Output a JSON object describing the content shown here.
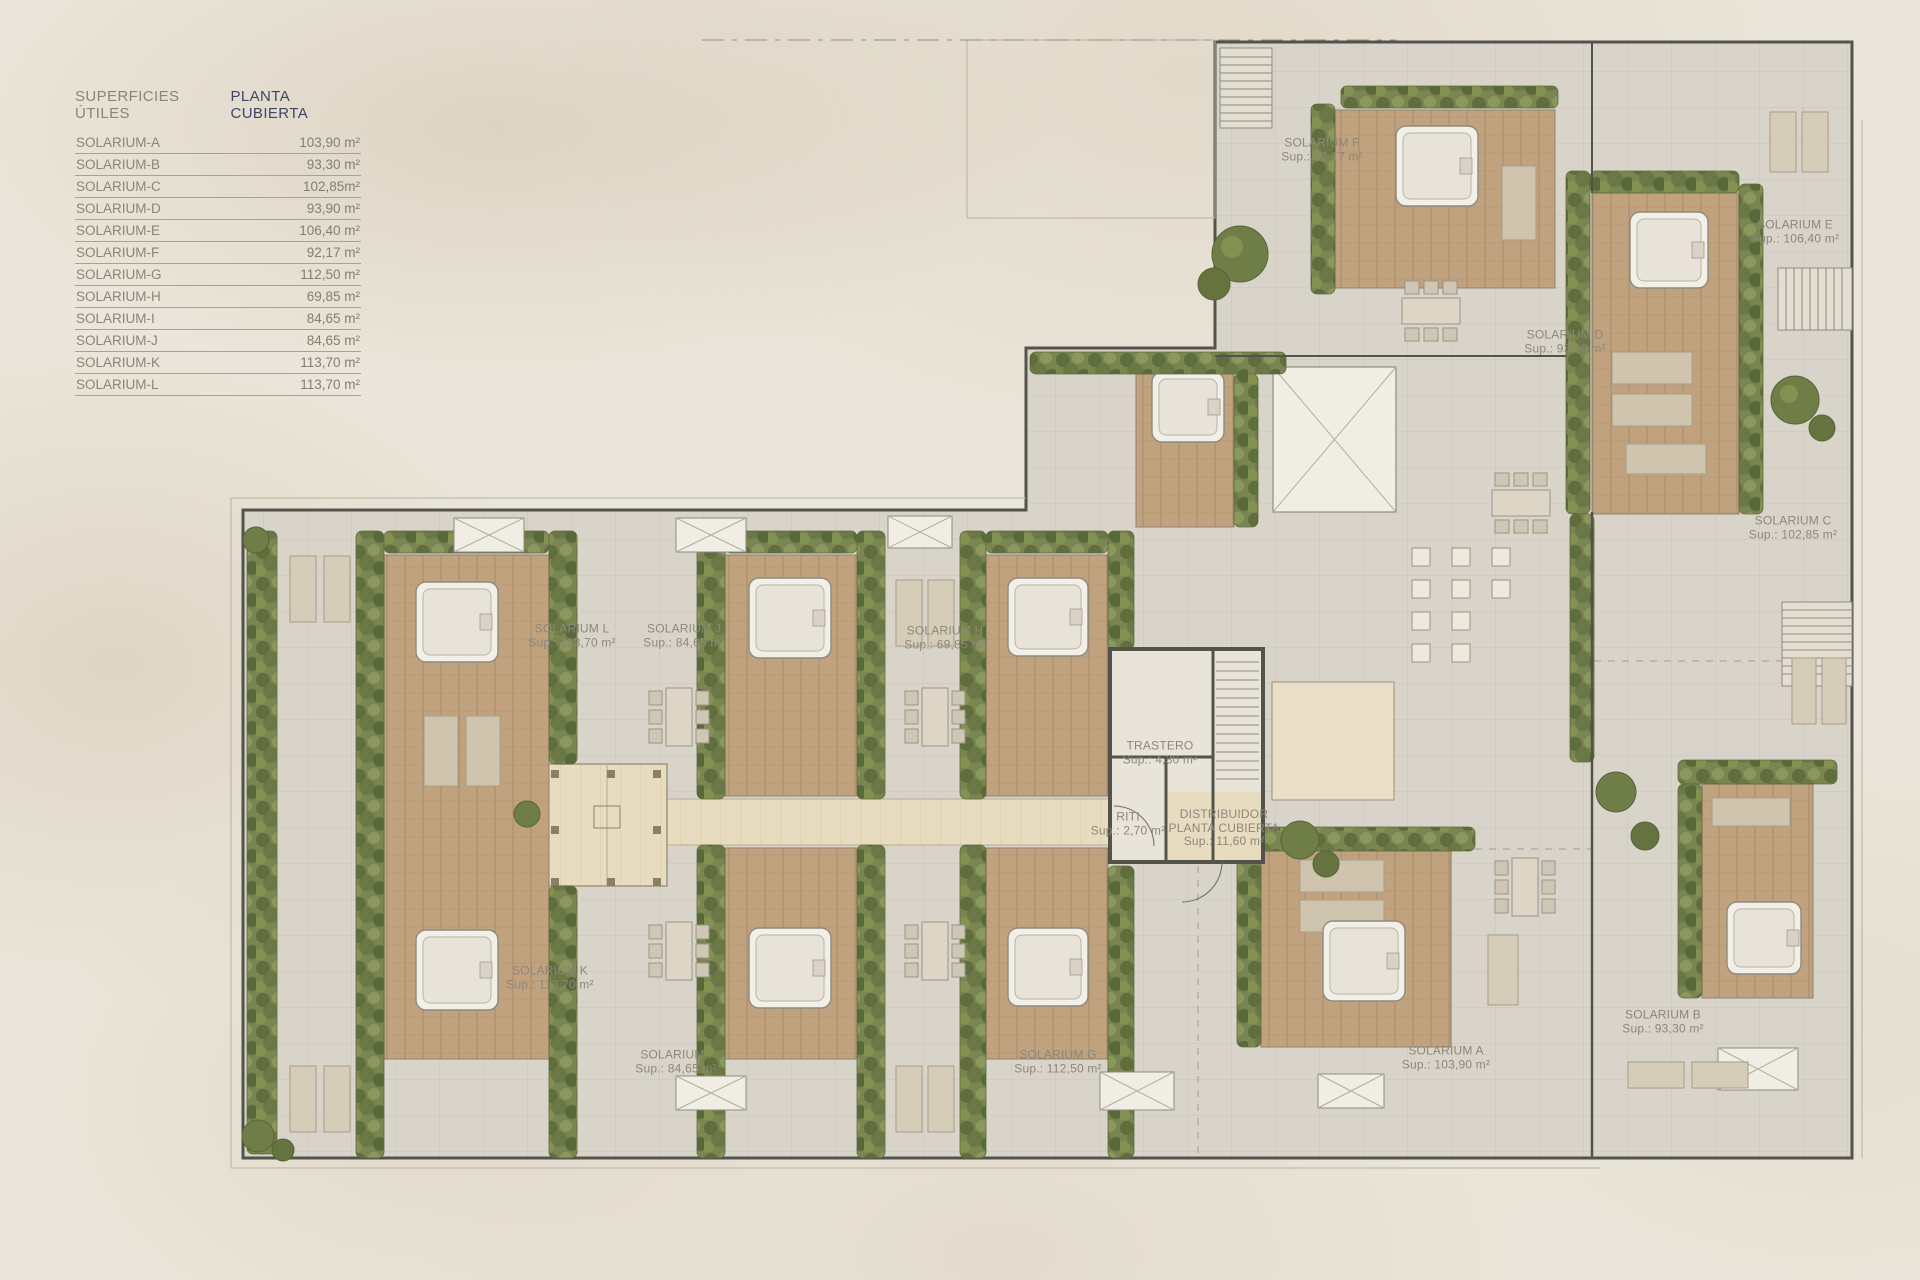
{
  "legend": {
    "title_left": "SUPERFICIES ÚTILES",
    "title_right": "PLANTA CUBIERTA",
    "rows": [
      {
        "label": "SOLARIUM-A",
        "value": "103,90 m²"
      },
      {
        "label": "SOLARIUM-B",
        "value": "93,30 m²"
      },
      {
        "label": "SOLARIUM-C",
        "value": "102,85m²"
      },
      {
        "label": "SOLARIUM-D",
        "value": "93,90 m²"
      },
      {
        "label": "SOLARIUM-E",
        "value": "106,40 m²"
      },
      {
        "label": "SOLARIUM-F",
        "value": "92,17 m²"
      },
      {
        "label": "SOLARIUM-G",
        "value": "112,50 m²"
      },
      {
        "label": "SOLARIUM-H",
        "value": "69,85 m²"
      },
      {
        "label": "SOLARIUM-I",
        "value": "84,65 m²"
      },
      {
        "label": "SOLARIUM-J",
        "value": "84,65 m²"
      },
      {
        "label": "SOLARIUM-K",
        "value": "113,70 m²"
      },
      {
        "label": "SOLARIUM-L",
        "value": "113,70 m²"
      }
    ]
  },
  "plan": {
    "labels": [
      {
        "id": "solarium-f",
        "lines": [
          "SOLARIUM F",
          "Sup.: 92,17 m²"
        ],
        "x": 1322,
        "y": 150
      },
      {
        "id": "solarium-e",
        "lines": [
          "SOLARIUM E",
          "Sup.: 106,40 m²"
        ],
        "x": 1795,
        "y": 232
      },
      {
        "id": "solarium-d",
        "lines": [
          "SOLARIUM D",
          "Sup.: 93,90 m²"
        ],
        "x": 1565,
        "y": 342
      },
      {
        "id": "solarium-c",
        "lines": [
          "SOLARIUM C",
          "Sup.: 102,85 m²"
        ],
        "x": 1793,
        "y": 528
      },
      {
        "id": "solarium-l",
        "lines": [
          "SOLARIUM L",
          "Sup.: 113,70 m²"
        ],
        "x": 572,
        "y": 636
      },
      {
        "id": "solarium-j",
        "lines": [
          "SOLARIUM J",
          "Sup.: 84,65 m²"
        ],
        "x": 684,
        "y": 636
      },
      {
        "id": "solarium-h",
        "lines": [
          "SOLARIUM H",
          "Sup.: 69,85 m²"
        ],
        "x": 945,
        "y": 638
      },
      {
        "id": "solarium-k",
        "lines": [
          "SOLARIUM K",
          "Sup.: 113,70 m²"
        ],
        "x": 550,
        "y": 978
      },
      {
        "id": "solarium-i",
        "lines": [
          "SOLARIUM I",
          "Sup.: 84,65 m²"
        ],
        "x": 676,
        "y": 1062
      },
      {
        "id": "solarium-g",
        "lines": [
          "SOLARIUM G",
          "Sup.: 112,50 m²"
        ],
        "x": 1058,
        "y": 1062
      },
      {
        "id": "solarium-a",
        "lines": [
          "SOLARIUM A",
          "Sup.: 103,90 m²"
        ],
        "x": 1446,
        "y": 1058
      },
      {
        "id": "solarium-b",
        "lines": [
          "SOLARIUM B",
          "Sup.: 93,30 m²"
        ],
        "x": 1663,
        "y": 1022
      },
      {
        "id": "trastero",
        "lines": [
          "TRASTERO",
          "Sup.: 4,30 m²"
        ],
        "x": 1160,
        "y": 753
      },
      {
        "id": "riti",
        "lines": [
          "RITI",
          "Sup.: 2,70 m²"
        ],
        "x": 1128,
        "y": 824
      },
      {
        "id": "distribuidor",
        "lines": [
          "DISTRIBUIDOR",
          "PLANTA CUBIERTA",
          "Sup.: 11,60 m²"
        ],
        "x": 1224,
        "y": 828
      }
    ]
  },
  "colors": {
    "background": "#ebe6db",
    "paving": "#d8d4ca",
    "wood_deck": "#c0a27f",
    "hedge_green": "#7a8551",
    "wall": "#54534b",
    "corridor_tan": "#e8dcc0",
    "accent_navy": "#3c4566",
    "label_text": "#8d8779"
  }
}
